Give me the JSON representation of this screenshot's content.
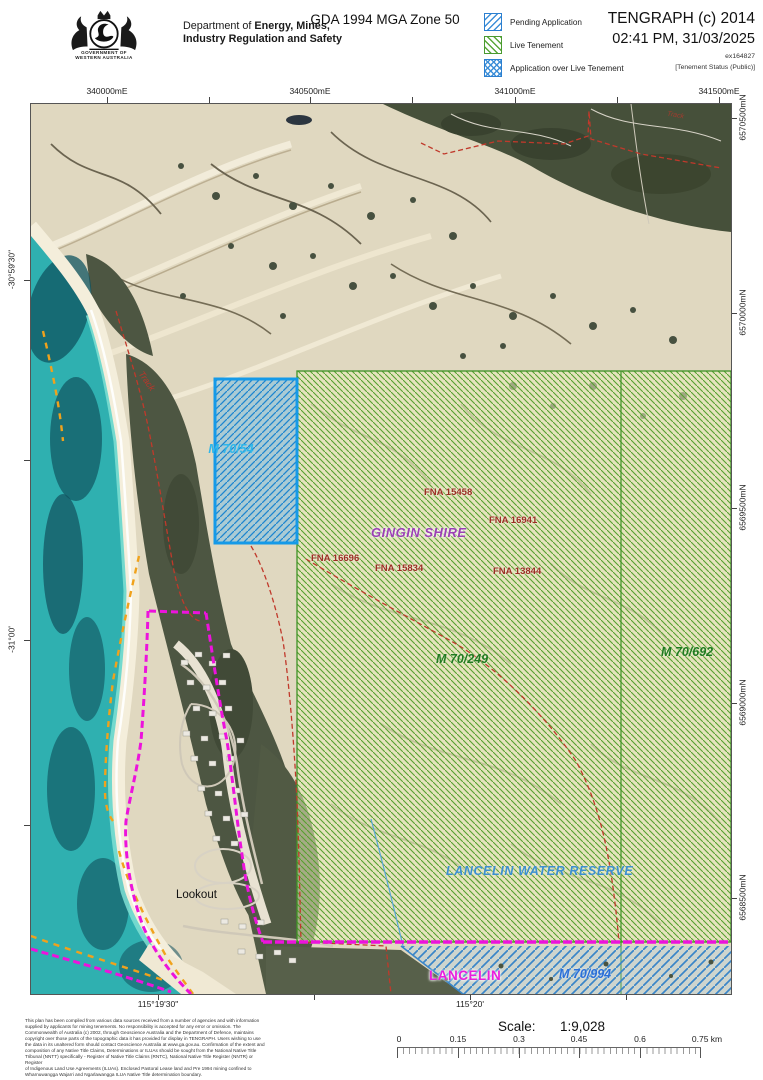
{
  "header": {
    "gov_caption": "GOVERNMENT OF\nWESTERN AUSTRALIA",
    "dept_prefix": "Department of ",
    "dept_bold1": "Energy, Mines,",
    "dept_bold2": "Industry Regulation and Safety",
    "projection": "GDA 1994 MGA Zone 50",
    "legend": {
      "pending": "Pending Application",
      "live": "Live Tenement",
      "over": "Application over Live Tenement"
    },
    "app_title": "TENGRAPH (c) 2014",
    "timestamp": "02:41 PM, 31/03/2025",
    "reference": "ex164827",
    "status_note": "[Tenement Status (Public)]"
  },
  "map": {
    "grid": {
      "top": [
        "340000mE",
        "340500mE",
        "341000mE",
        "341500mE"
      ],
      "right": [
        "6570500mN",
        "6570000mN",
        "6569500mN",
        "6569000mN",
        "6568500mN"
      ],
      "left": [
        "-30°59'30\"",
        "-31°00'"
      ],
      "bottom": [
        "115°19'30\"",
        "115°20'"
      ]
    },
    "labels": {
      "m70_54": "M 70/54",
      "m70_249": "M 70/249",
      "m70_692": "M 70/692",
      "m70_994": "M 70/994",
      "fna15458": "FNA 15458",
      "fna16941": "FNA 16941",
      "fna16696": "FNA 16696",
      "fna15834": "FNA 15834",
      "fna13844": "FNA 13844",
      "shire": "GINGIN SHIRE",
      "reserve": "LANCELIN WATER RESERVE",
      "town": "LANCELIN",
      "lookout": "Lookout",
      "track": "Track"
    },
    "colors": {
      "pending_blue": "#2b7fd0",
      "live_green": "#4a9a30",
      "boundary_magenta": "#ec13dc",
      "track_orange": "#f0a21c",
      "road_red": "#c0392b"
    }
  },
  "footer": {
    "disclaimer": "This plan has been compiled from various data sources received from a number of agencies and with information\nsupplied by applicants for mining tenements. No responsibility is accepted for any error or omission. The\nCommonwealth of Australia (c) 2002, through Geoscience Australia and the Department of Defence, maintains\ncopyright over those parts of the topographic data it has provided for display in TENGRAPH. Users wishing to use\nthe data in its unaltered form should contact Geoscience Australia at www.ga.gov.au. Confirmation of the extent and\ncomposition of any Native Title Claims, Determinations or ILUAs should be sought from the National Native Title\nTribunal (NNTT) specifically - Register of Native Title Claims (RNTC), National Native Title Register (NNTR) or Register\nof Indigenous Land Use Agreements (ILUAs). Enclosed Pastoral Lease land and Pre 1994 mining confined to\nWharnuwangga Wajarri and Ngarlawangga ILUA Native Title determination boundary.",
    "scale_label": "Scale:",
    "scale_value": "1:9,028",
    "scalebar": [
      "0",
      "0.15",
      "0.3",
      "0.45",
      "0.6",
      "0.75 km"
    ]
  }
}
